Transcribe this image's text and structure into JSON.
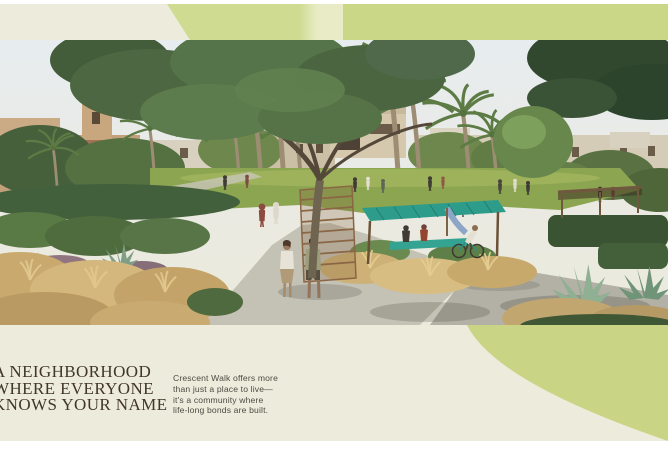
{
  "colors": {
    "page_cream": "#edecdc",
    "band_green_left": "#cedb90",
    "band_green_right": "#cad786",
    "swoosh_green": "#c9d584",
    "headline_text": "#41362a",
    "body_text": "#4c4a43",
    "margin_white": "#ffffff"
  },
  "hero": {
    "alt": "Rendered park promenade with palm trees, leafy trees, beige villas, lawns, curved walking paths, planting beds and residents strolling"
  },
  "headline": {
    "lines": [
      "A NEIGHBORHOOD",
      "WHERE EVERYONE",
      "KNOWS YOUR NAME"
    ]
  },
  "body": {
    "lines": [
      "Crescent Walk offers more",
      "than just a place to live—",
      "it's a community where",
      "life-long bonds are built."
    ]
  }
}
